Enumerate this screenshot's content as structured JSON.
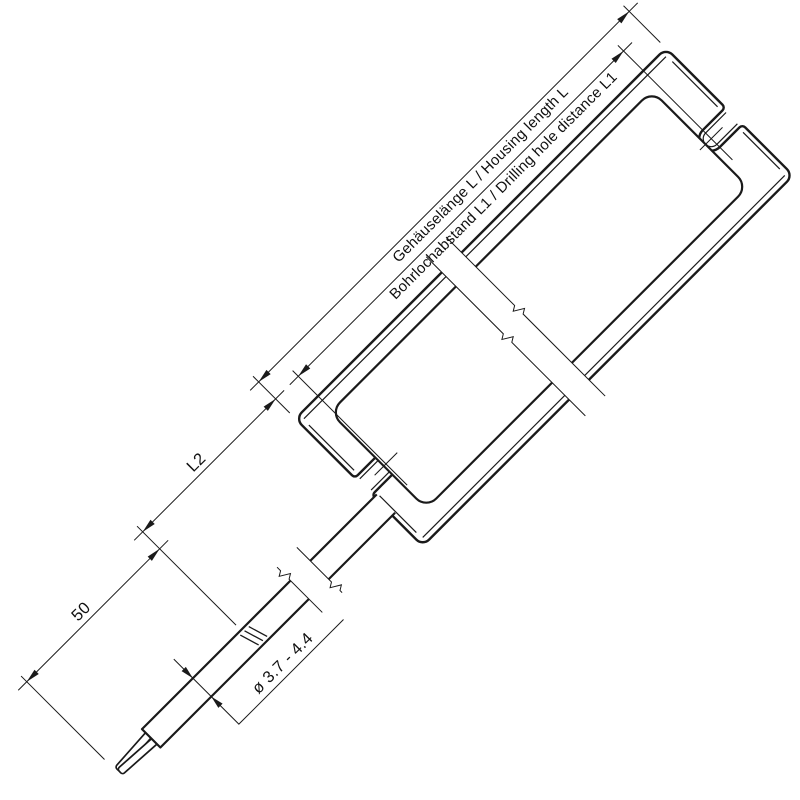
{
  "drawing": {
    "type": "technical-dimension-drawing",
    "background": "#ffffff",
    "line_color": "#1a1a1a",
    "labels": {
      "housing_length": "Gehäuselänge L / Housing length L",
      "hole_distance": "Bohrlochabstand L1 / Drilling hole distance L1",
      "l2": "L2",
      "strip_length": "50",
      "cable_diameter": "ø 3.7 - 4.4"
    }
  }
}
